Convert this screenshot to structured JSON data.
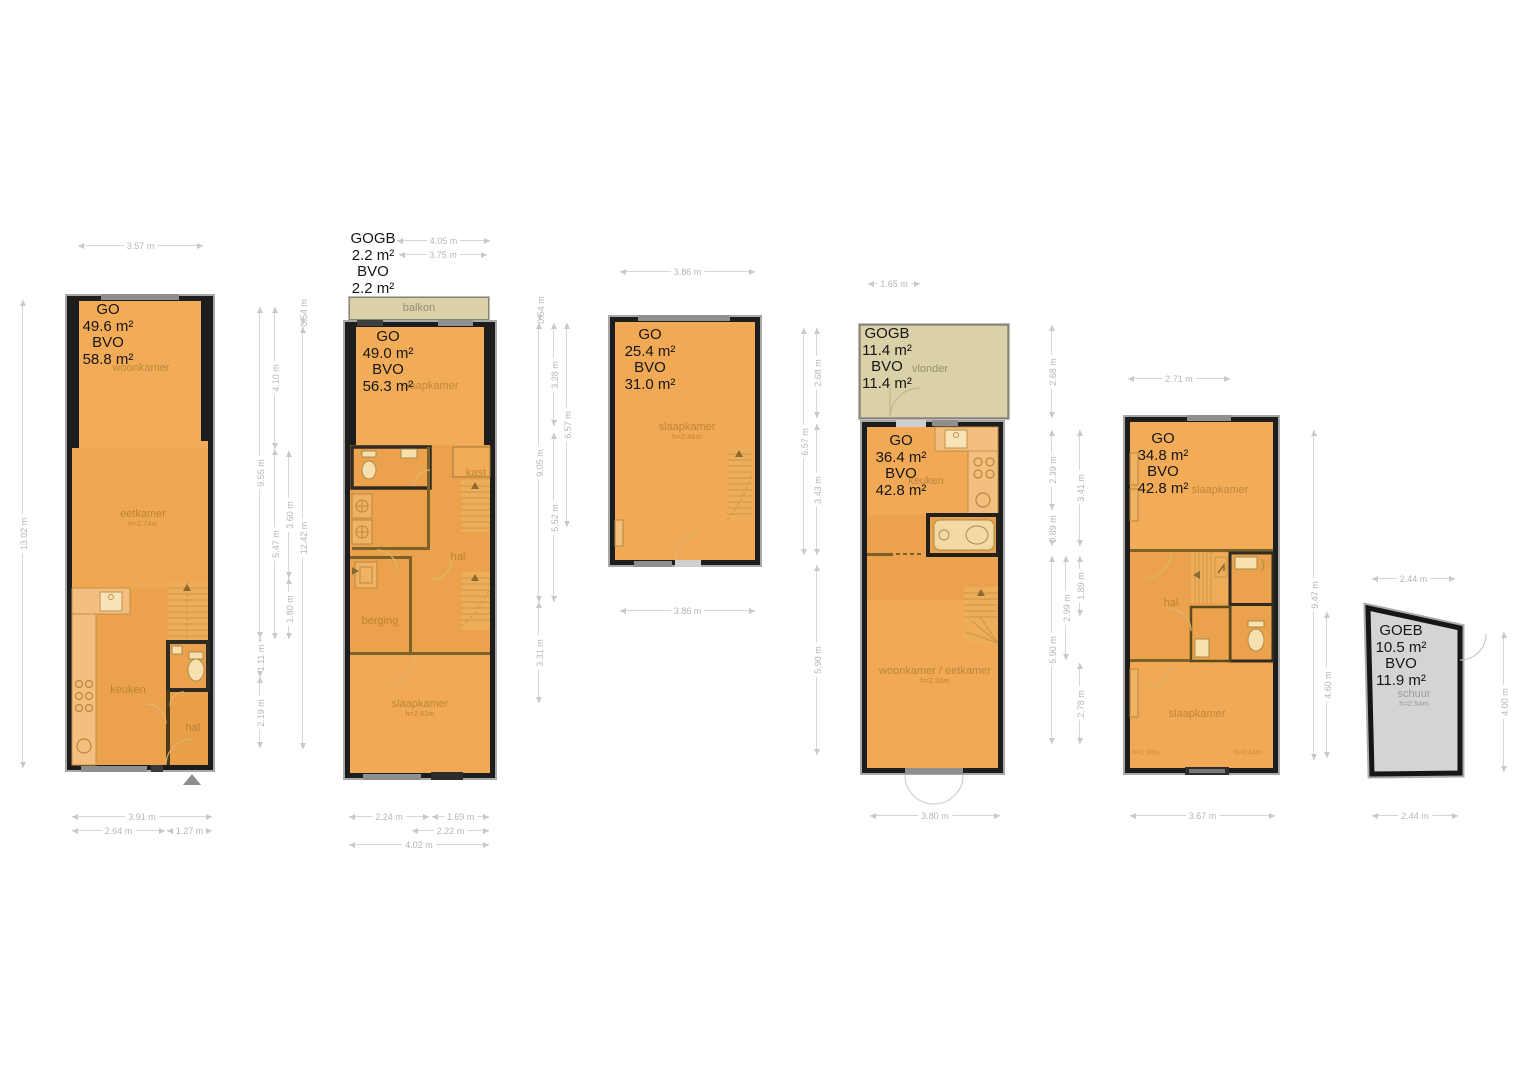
{
  "colors": {
    "floor": "#F1A955",
    "floor_dark": "#ECA24C",
    "counter": "#F4BF7E",
    "balcony": "#DAD1A8",
    "shed": "#D4D4D4",
    "wall": "#1D1D1D",
    "dimension_text": "#B6B6B6"
  },
  "units": [
    {
      "id": "level-1",
      "area": {
        "go_label": "GO",
        "go_value": "49.6 m²",
        "bvo_label": "BVO",
        "bvo_value": "58.8 m²"
      },
      "rooms": {
        "woonkamer": "woonkamer",
        "eetkamer": "eetkamer",
        "eetkamer_h": "h=2.74m",
        "keuken": "keuken",
        "hal": "hal"
      },
      "dims": {
        "top": "3.57 m",
        "left": "13.02 m",
        "right": [
          "9.55 m",
          "1.11 m",
          "2.19 m",
          "4.10 m",
          "5.47 m",
          "3.60 m",
          "1.80 m",
          "0.54 m",
          "12.42 m"
        ],
        "bottom": [
          "3.91 m",
          "2.64 m",
          "1.27 m"
        ]
      }
    },
    {
      "id": "level-2",
      "gogb": {
        "label": "GOGB",
        "value": "2.2 m²",
        "bvo_label": "BVO",
        "bvo_value": "2.2 m²"
      },
      "area": {
        "go_label": "GO",
        "go_value": "49.0 m²",
        "bvo_label": "BVO",
        "bvo_value": "56.3 m²"
      },
      "rooms": {
        "balkon": "balkon",
        "slaapkamer_top": "slaapkamer",
        "kast": "kast",
        "hal": "hal",
        "berging": "berging",
        "slaapkamer_bottom": "slaapkamer",
        "slaapkamer_bottom_h": "h=2.62m"
      },
      "dims": {
        "top": [
          "4.05 m",
          "3.75 m"
        ],
        "right": [
          "0.54 m",
          "9.05 m",
          "3.31 m",
          "3.28 m",
          "5.52 m",
          "6.57 m"
        ],
        "bottom": [
          "2.24 m",
          "1.69 m",
          "2.22 m",
          "4.02 m"
        ]
      }
    },
    {
      "id": "level-3",
      "area": {
        "go_label": "GO",
        "go_value": "25.4 m²",
        "bvo_label": "BVO",
        "bvo_value": "31.0 m²"
      },
      "rooms": {
        "slaapkamer": "slaapkamer",
        "slaapkamer_h": "h=2.46m"
      },
      "dims": {
        "top": "3.86 m",
        "right": [
          "6.57 m",
          "2.68 m",
          "3.43 m",
          "5.90 m"
        ],
        "bottom": "3.86 m"
      }
    },
    {
      "id": "level-4",
      "gogb": {
        "label": "GOGB",
        "value": "11.4 m²",
        "bvo_label": "BVO",
        "bvo_value": "11.4 m²"
      },
      "area": {
        "go_label": "GO",
        "go_value": "36.4 m²",
        "bvo_label": "BVO",
        "bvo_value": "42.8 m²"
      },
      "rooms": {
        "vlonder": "vlonder",
        "keuken": "keuken",
        "woonkamer": "woonkamer / eetkamer",
        "woonkamer_h": "h=2.56m"
      },
      "dims": {
        "top": "1.65 m",
        "right": [
          "2.68 m",
          "2.39 m",
          "0.89 m",
          "5.90 m",
          "2.99 m",
          "3.41 m",
          "1.89 m",
          "2.78 m"
        ],
        "bottom": "3.80 m"
      }
    },
    {
      "id": "level-5",
      "area": {
        "go_label": "GO",
        "go_value": "34.8 m²",
        "bvo_label": "BVO",
        "bvo_value": "42.8 m²"
      },
      "rooms": {
        "slaapkamer_top": "slaapkamer",
        "hal": "hal",
        "slaapkamer_bottom": "slaapkamer",
        "h_left": "h=1.98m",
        "h_right": "h=2.44m"
      },
      "dims": {
        "top": "2.71 m",
        "right": [
          "9.47 m",
          "4.60 m"
        ],
        "bottom": "3.67 m"
      }
    },
    {
      "id": "schuur",
      "area": {
        "go_label": "GOEB",
        "go_value": "10.5 m²",
        "bvo_label": "BVO",
        "bvo_value": "11.9 m²"
      },
      "rooms": {
        "schuur": "schuur",
        "schuur_h": "h=2.54m"
      },
      "dims": {
        "top": "2.44 m",
        "right": [
          "4.00 m"
        ],
        "bottom": "2.44 m"
      }
    }
  ]
}
